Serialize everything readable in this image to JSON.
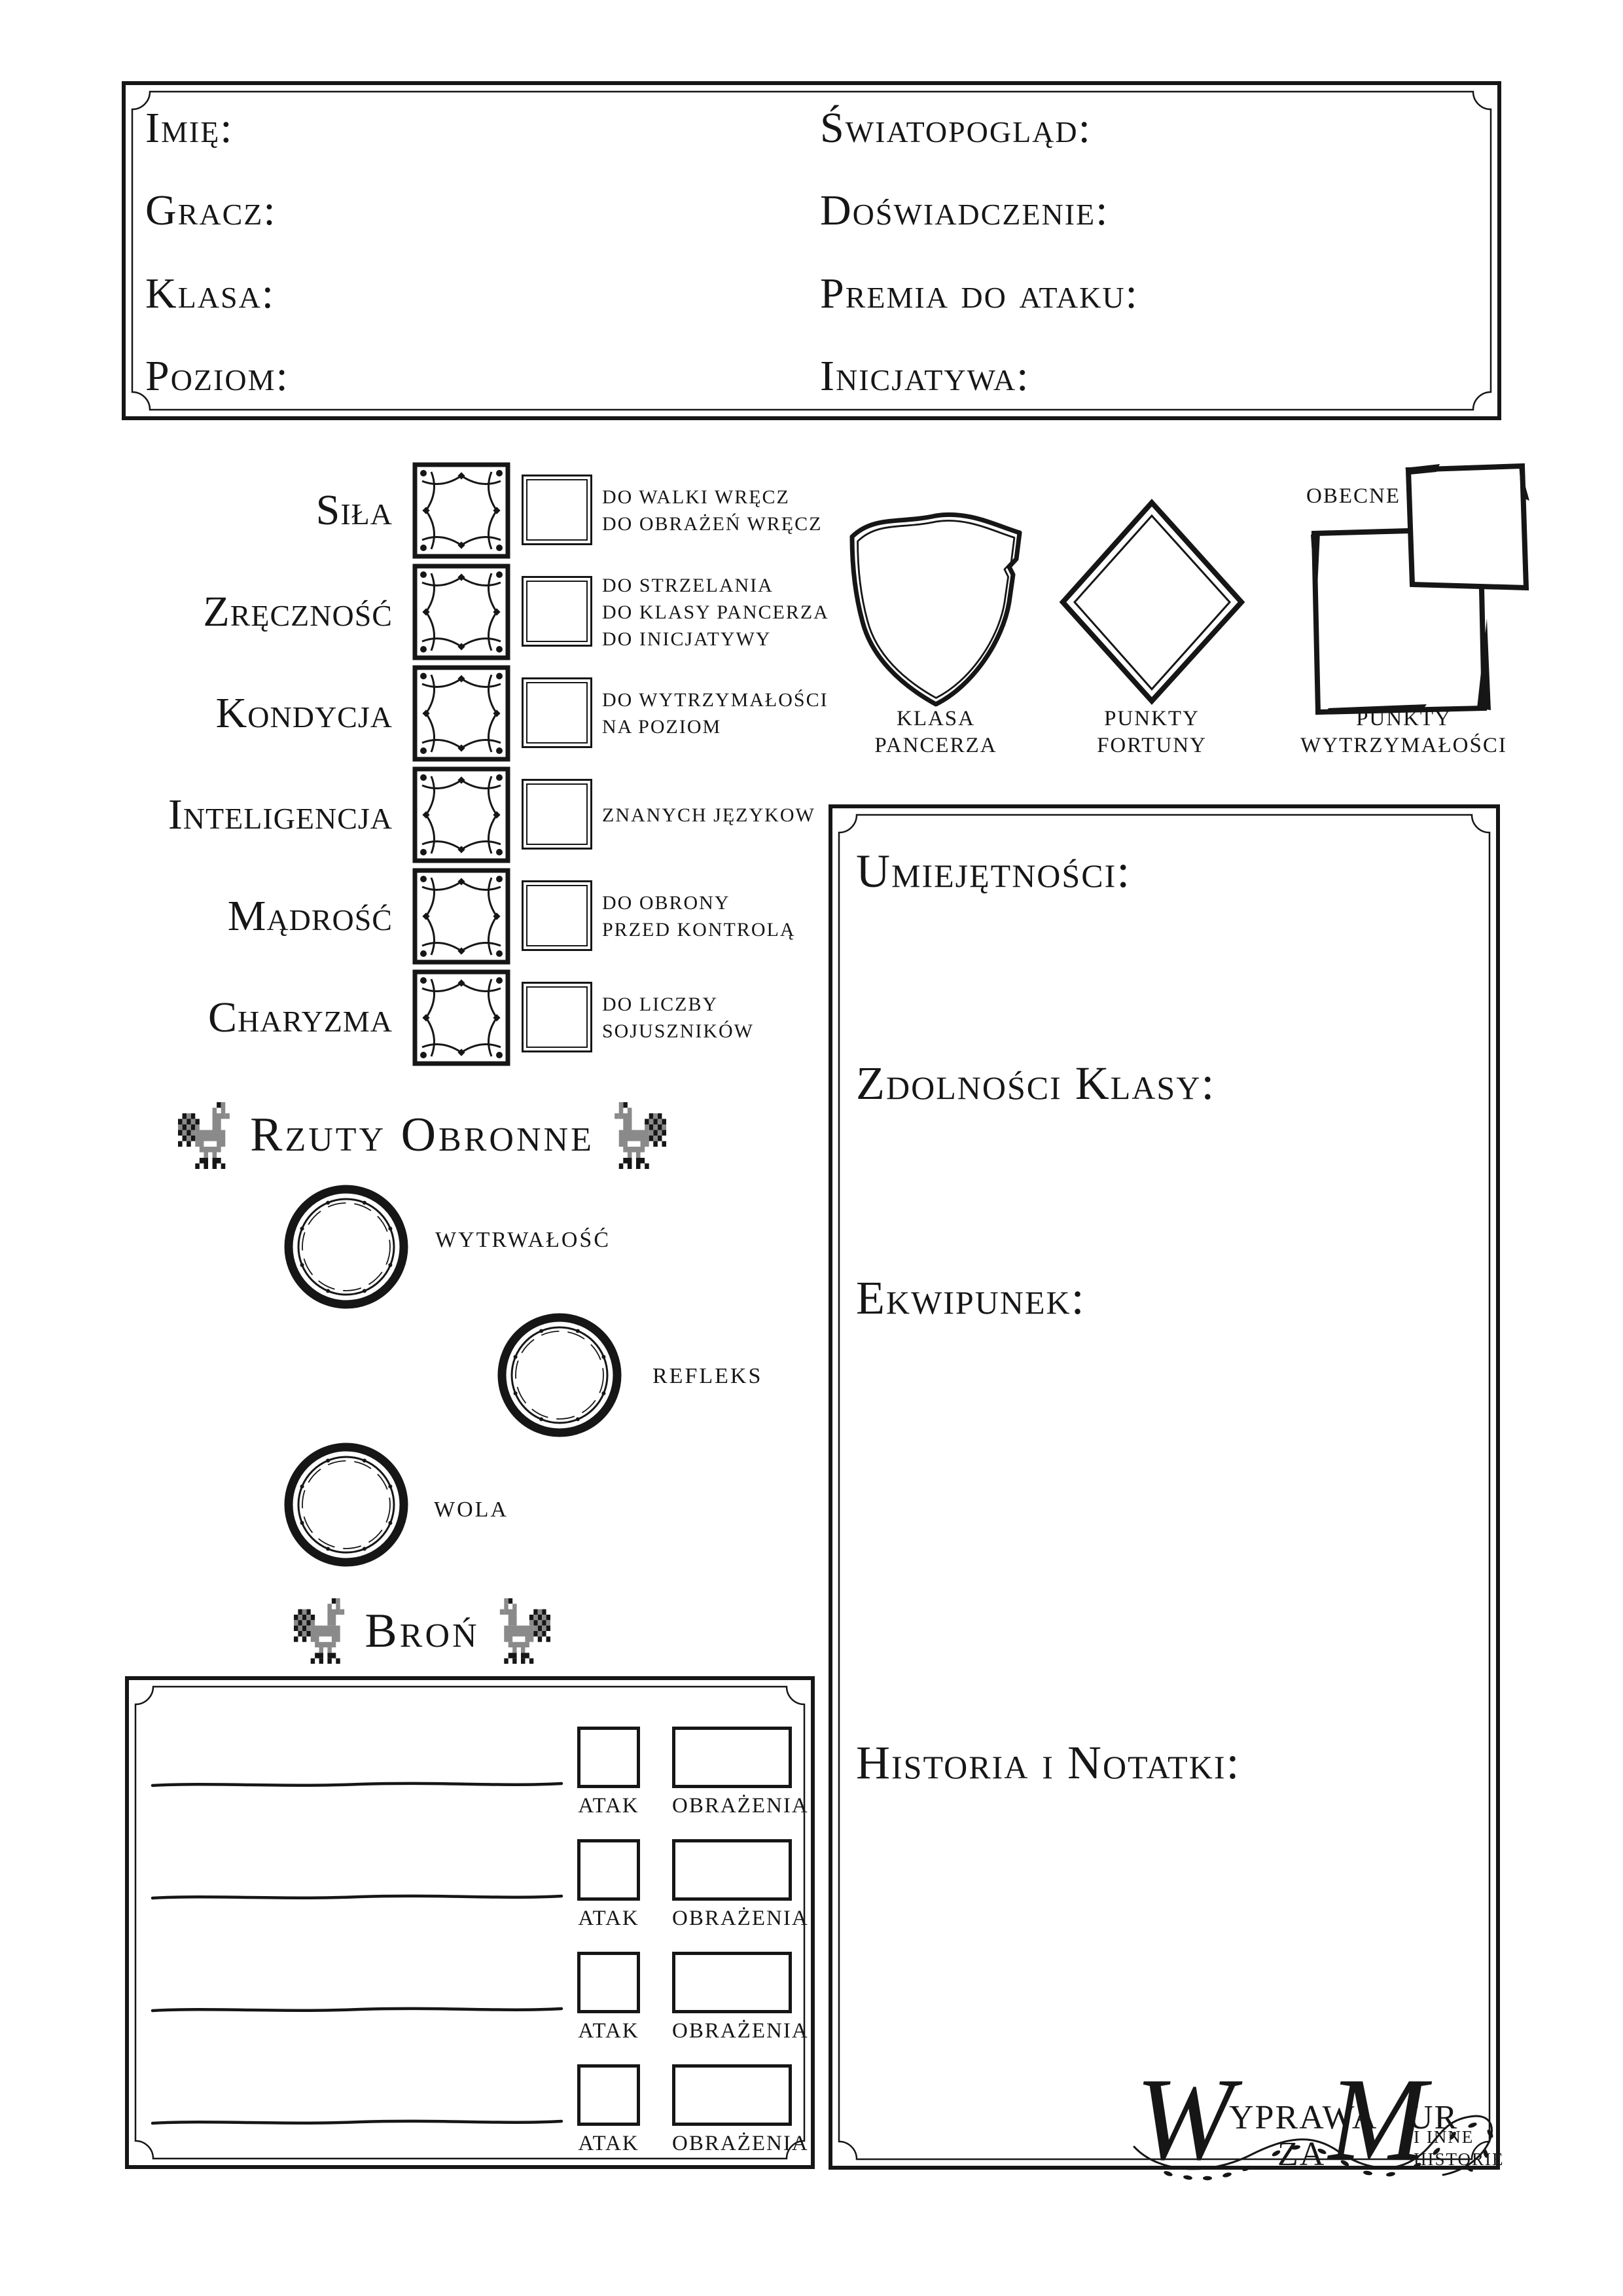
{
  "colors": {
    "ink": "#161616",
    "paper": "#ffffff",
    "rooster_gray": "#8a8a8a"
  },
  "header": {
    "fields_left": [
      "Imię:",
      "Gracz:",
      "Klasa:",
      "Poziom:"
    ],
    "fields_right": [
      "Światopogląd:",
      "Doświadczenie:",
      "Premia do ataku:",
      "Inicjatywa:"
    ]
  },
  "attributes": [
    {
      "name": "Siła",
      "notes": [
        "DO WALKI WRĘCZ",
        "DO OBRAŻEŃ WRĘCZ"
      ]
    },
    {
      "name": "Zręczność",
      "notes": [
        "DO STRZELANIA",
        "DO KLASY PANCERZA",
        "DO INICJATYWY"
      ]
    },
    {
      "name": "Kondycja",
      "notes": [
        "DO WYTRZYMAŁOŚCI",
        "NA POZIOM"
      ]
    },
    {
      "name": "Inteligencja",
      "notes": [
        "ZNANYCH JĘZYKOW"
      ]
    },
    {
      "name": "Mądrość",
      "notes": [
        "DO OBRONY",
        "PRZED KONTROLĄ"
      ]
    },
    {
      "name": "Charyzma",
      "notes": [
        "DO LICZBY",
        "SOJUSZNIKÓW"
      ]
    }
  ],
  "stats": {
    "armor_class": {
      "lines": [
        "KLASA",
        "PANCERZA"
      ]
    },
    "fortune_points": {
      "lines": [
        "PUNKTY",
        "FORTUNY"
      ]
    },
    "hit_points": {
      "lines": [
        "PUNKTY",
        "WYTRZYMAŁOŚCI"
      ],
      "current_label": "OBECNE"
    }
  },
  "saving_throws": {
    "title": "Rzuty Obronne",
    "items": [
      "WYTRWAŁOŚĆ",
      "REFLEKS",
      "WOLA"
    ]
  },
  "weapons": {
    "title": "Broń",
    "attack_label": "ATAK",
    "damage_label": "OBRAŻENIA"
  },
  "right_panel": {
    "sections": [
      "Umiejętności:",
      "Zdolności Klasy:",
      "Ekwipunek:",
      "Historia i Notatki:"
    ]
  },
  "logo": {
    "word1_initial": "W",
    "word1_rest": "YPRAWA",
    "word2": "ZA",
    "word3_initial": "M",
    "word3_rest": "UR",
    "tagline_line1": "I INNE",
    "tagline_line2": "HISTORIE"
  }
}
